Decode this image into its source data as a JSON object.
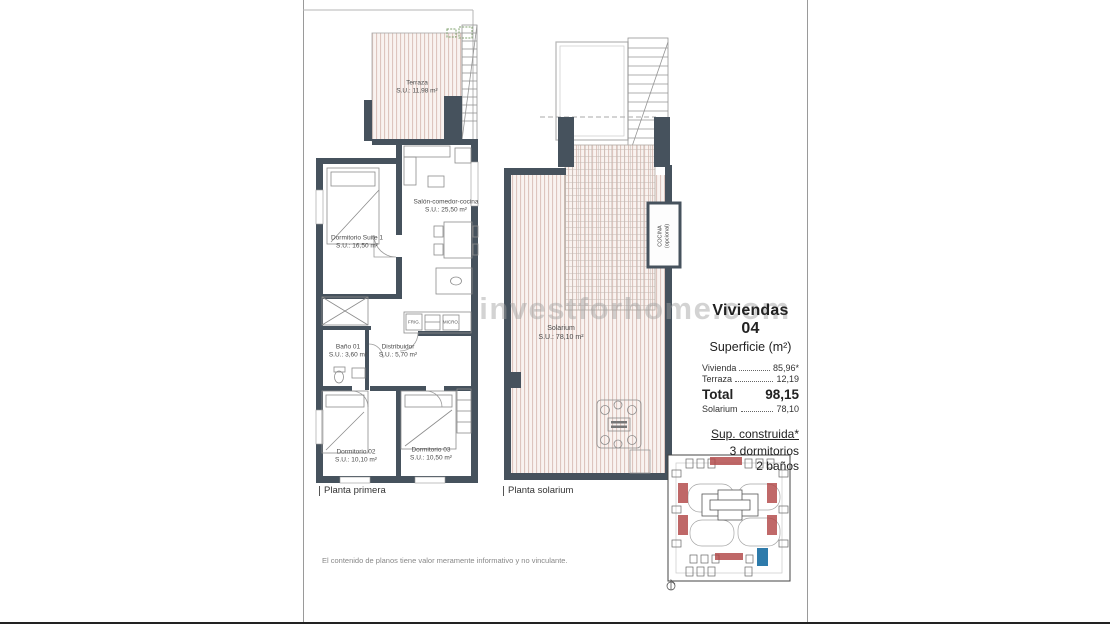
{
  "watermark": "investforhome.com",
  "plan_primera": {
    "title": "Planta primera",
    "rooms": {
      "terraza": {
        "name": "Terraza",
        "area": "S.U.: 11,98 m²"
      },
      "suite": {
        "name": "Dormitorio Suite 1",
        "area": "S.U.: 16,50 m²"
      },
      "salon": {
        "name": "Salón-comedor-cocina",
        "area": "S.U.: 25,50 m²"
      },
      "bano": {
        "name": "Baño 01",
        "area": "S.U.: 3,60 m²"
      },
      "distribuidor": {
        "name": "Distribuidor",
        "area": "S.U.: 5,70 m²"
      },
      "dorm02": {
        "name": "Dormitorio 02",
        "area": "S.U.: 10,10 m²"
      },
      "dorm03": {
        "name": "Dormitorio 03",
        "area": "S.U.: 10,50 m²"
      }
    },
    "kitchen_labels": {
      "frig": "FRIG.",
      "micro": "MICRO."
    }
  },
  "plan_solarium": {
    "title": "Planta solarium",
    "rooms": {
      "solarium": {
        "name": "Solarium",
        "area": "S.U.: 78,10 m²"
      },
      "cocina": {
        "name": "COCINA (opcional)"
      }
    }
  },
  "info": {
    "title": "Viviendas 04",
    "subtitle": "Superficie (m²)",
    "rows": [
      {
        "label": "Vivienda",
        "value": "85,96*"
      },
      {
        "label": "Terraza",
        "value": "12,19"
      }
    ],
    "total": {
      "label": "Total",
      "value": "98,15"
    },
    "solarium_row": {
      "label": "Solarium",
      "value": "78,10"
    },
    "built": {
      "heading": "Sup. construida*",
      "features": [
        "3 dormitorios",
        "2 baños"
      ]
    }
  },
  "footer": {
    "disclaimer": "El contenido de planos tiene valor meramente informativo y no vinculante."
  },
  "colors": {
    "wall": "#46525d",
    "hatch": "#ddc5be",
    "accent_red": "#b24848",
    "accent_blue": "#2e7bab"
  }
}
